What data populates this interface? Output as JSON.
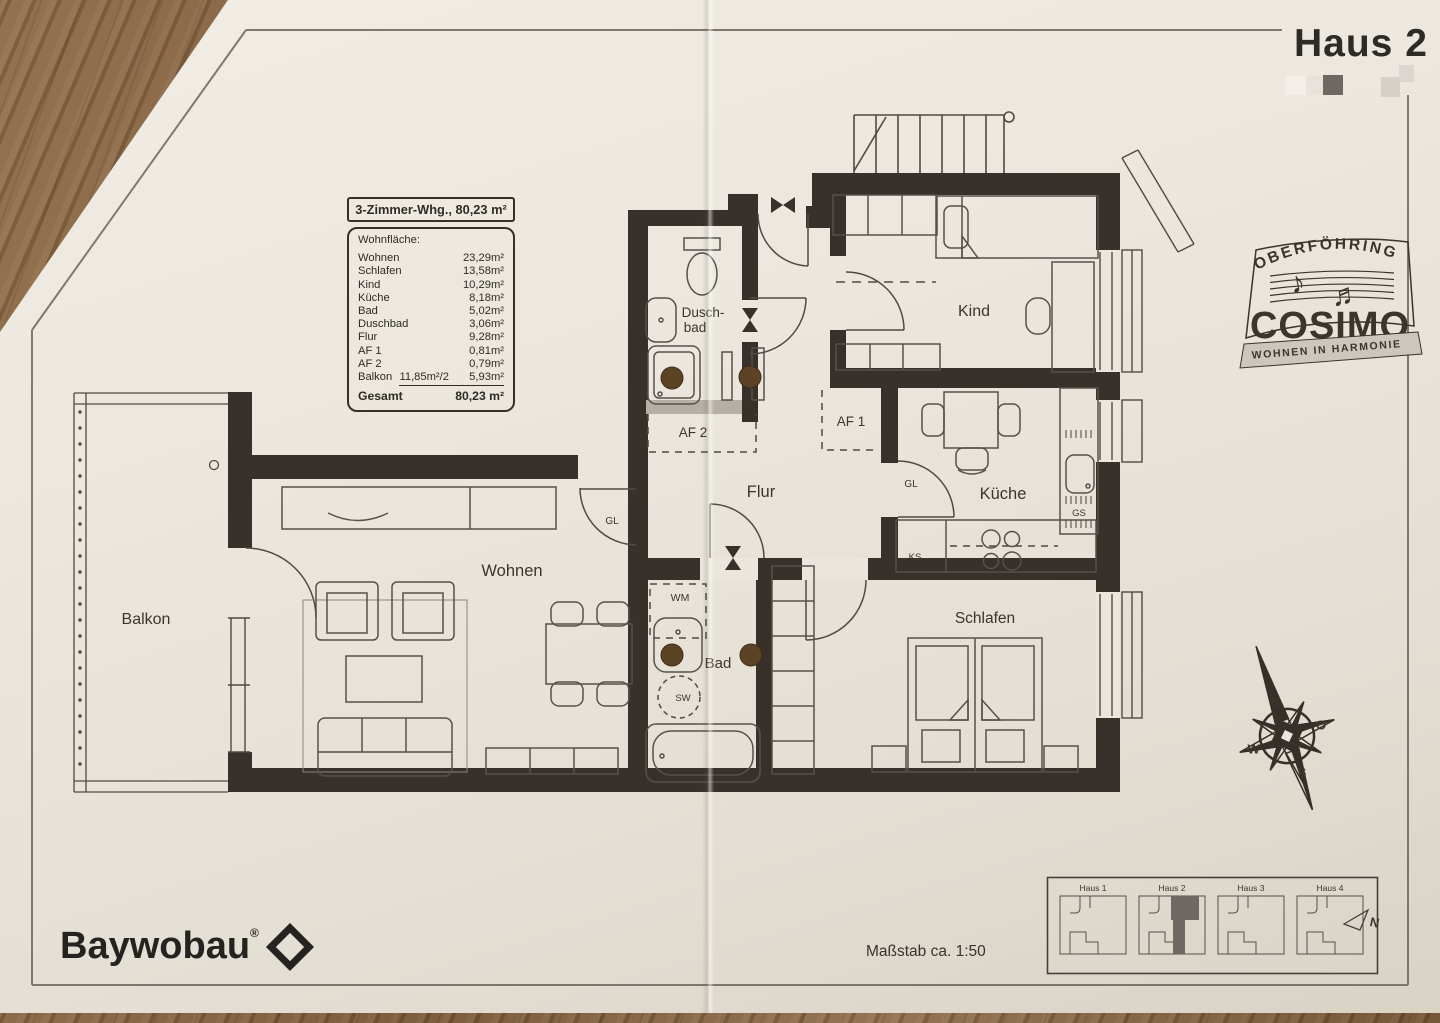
{
  "page": {
    "title": "Haus 2",
    "scale_note": "Maßstab ca. 1:50"
  },
  "info": {
    "title": "3-Zimmer-Whg., 80,23 m²",
    "header": "Wohnfläche:",
    "rows": [
      {
        "label": "Wohnen",
        "value": "23,29m²"
      },
      {
        "label": "Schlafen",
        "value": "13,58m²"
      },
      {
        "label": "Kind",
        "value": "10,29m²"
      },
      {
        "label": "Küche",
        "value": "8,18m²"
      },
      {
        "label": "Bad",
        "value": "5,02m²"
      },
      {
        "label": "Duschbad",
        "value": "3,06m²"
      },
      {
        "label": "Flur",
        "value": "9,28m²"
      },
      {
        "label": "AF 1",
        "value": "0,81m²"
      },
      {
        "label": "AF 2",
        "value": "0,79m²"
      },
      {
        "label": "Balkon",
        "mid": "11,85m²/2",
        "value": "5,93m²"
      }
    ],
    "total_label": "Gesamt",
    "total_value": "80,23 m²"
  },
  "rooms": {
    "balkon": "Balkon",
    "wohnen": "Wohnen",
    "flur": "Flur",
    "bad": "Bad",
    "duschbad1": "Dusch-",
    "duschbad2": "bad",
    "kind": "Kind",
    "kueche": "Küche",
    "schlafen": "Schlafen",
    "af1": "AF 1",
    "af2": "AF 2"
  },
  "plan_labels": {
    "gl_wohnen": "GL",
    "gl_kueche": "GL",
    "wm": "WM",
    "sw": "SW",
    "ks": "KS",
    "gs": "GS"
  },
  "logos": {
    "cosimo": {
      "top": "OBERFÖHRING",
      "name": "COSIMO",
      "tagline": "WOHNEN IN HARMONIE"
    },
    "baywobau": {
      "name": "Baywobau",
      "registered": "®"
    }
  },
  "compass": {
    "n": "N",
    "o": "O",
    "s": "S",
    "w": "W"
  },
  "siteplan": {
    "houses": [
      "Haus 1",
      "Haus 2",
      "Haus 3",
      "Haus 4"
    ],
    "north": "N"
  },
  "colors": {
    "wall": "#38302a",
    "paper": "#e9e5dc",
    "wood": "#7c5d3e",
    "highlight_unit": "#6e6963"
  }
}
